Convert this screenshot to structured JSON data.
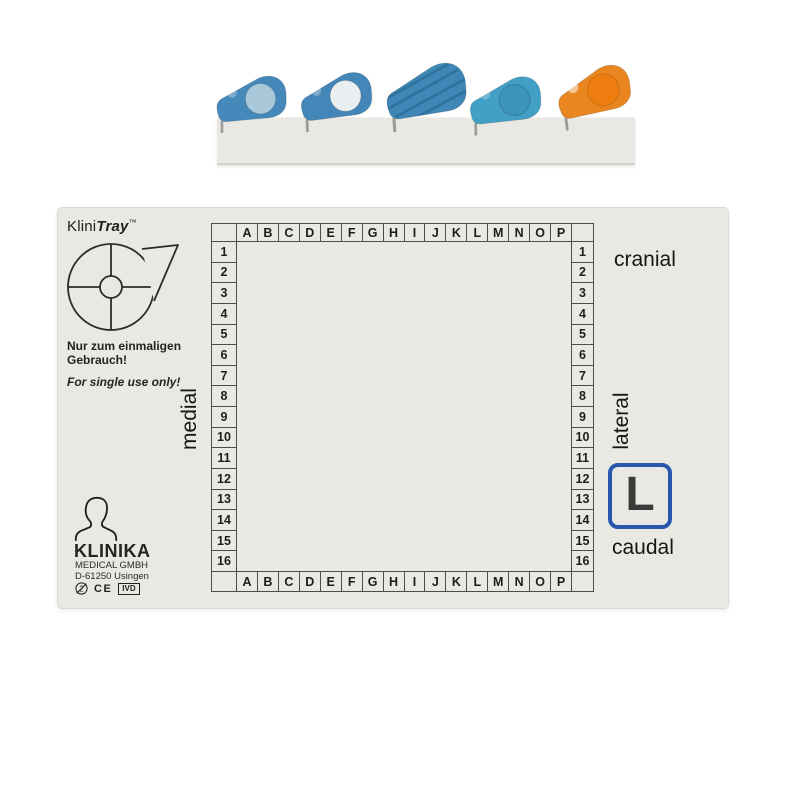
{
  "page": {
    "background": "#ffffff"
  },
  "clips_rack": {
    "strip_color": "#e9e8e2",
    "clips": [
      {
        "label": "blue clip with frosted window",
        "body": "#4589ba",
        "accent": "#a9c9db",
        "variant": "circle"
      },
      {
        "label": "blue clip with white window",
        "body": "#4586b8",
        "accent": "#e9eef0",
        "variant": "circle"
      },
      {
        "label": "blue clip ribbed back",
        "body": "#3f87b7",
        "accent": "#2e6e99",
        "variant": "ribbed"
      },
      {
        "label": "light blue clip plain window",
        "body": "#429fc5",
        "accent": "#3b94ba",
        "variant": "circle"
      },
      {
        "label": "orange clip with window",
        "body": "#e98620",
        "accent": "#ec7d0e",
        "variant": "circle"
      }
    ]
  },
  "tray": {
    "surface_color": "#e9e8e2",
    "brand": {
      "prefix": "Klini",
      "name": "Tray",
      "tm": "™"
    },
    "single_use": {
      "de_line1": "Nur zum einmaligen",
      "de_line2": "Gebrauch!",
      "en": "For single use only!"
    },
    "orientation": {
      "top": "cranial",
      "bottom": "caudal",
      "left": "medial",
      "right": "lateral",
      "side_marker": "L",
      "marker_box_color": "#2857b0"
    },
    "grid": {
      "columns": [
        "A",
        "B",
        "C",
        "D",
        "E",
        "F",
        "G",
        "H",
        "I",
        "J",
        "K",
        "L",
        "M",
        "N",
        "O",
        "P"
      ],
      "rows": [
        "1",
        "2",
        "3",
        "4",
        "5",
        "6",
        "7",
        "8",
        "9",
        "10",
        "11",
        "12",
        "13",
        "14",
        "15",
        "16"
      ]
    },
    "manufacturer": {
      "logo_text": "KLINIKA",
      "line1": "MEDICAL GMBH",
      "line2": "D-61250 Usingen",
      "do_not_reuse_digit": "2",
      "ce_label": "CE",
      "ivd_label": "IVD"
    }
  }
}
